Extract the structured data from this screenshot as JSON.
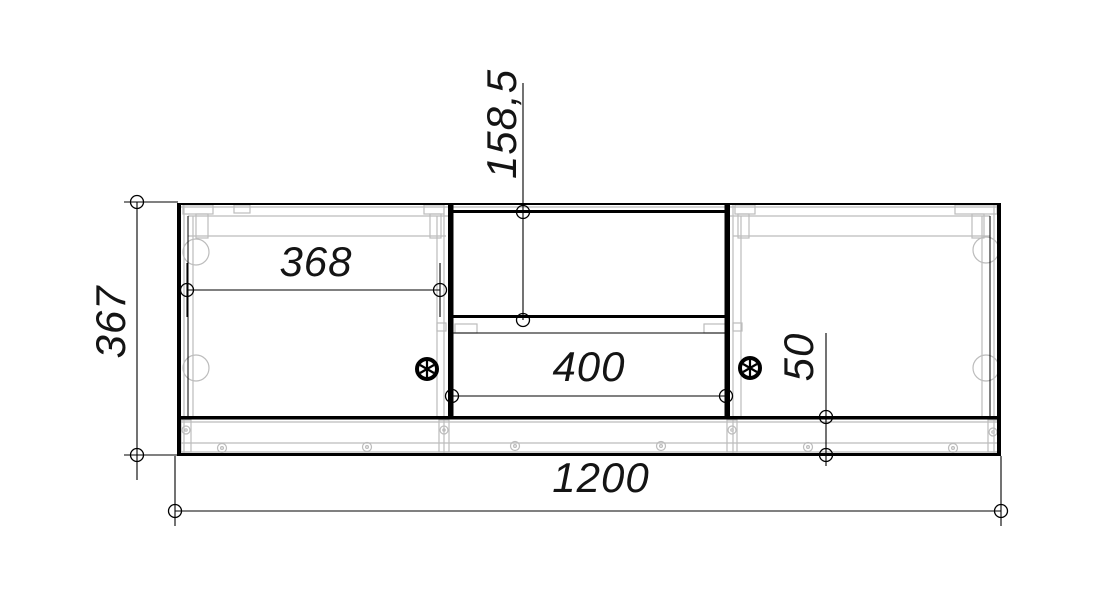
{
  "colors": {
    "background": "#ffffff",
    "line": "#000000",
    "hidden_detail": "#bcbcbc",
    "text": "#141414"
  },
  "dimensions": {
    "overall_height": {
      "label": "367"
    },
    "overall_width": {
      "label": "1200"
    },
    "left_section_width": {
      "label": "368"
    },
    "niche_height": {
      "label": "158,5"
    },
    "niche_width": {
      "label": "400"
    },
    "plinth_height": {
      "label": "50"
    }
  },
  "icons": {
    "left_fastener": "cam-lock-icon",
    "right_fastener": "cam-lock-icon"
  }
}
